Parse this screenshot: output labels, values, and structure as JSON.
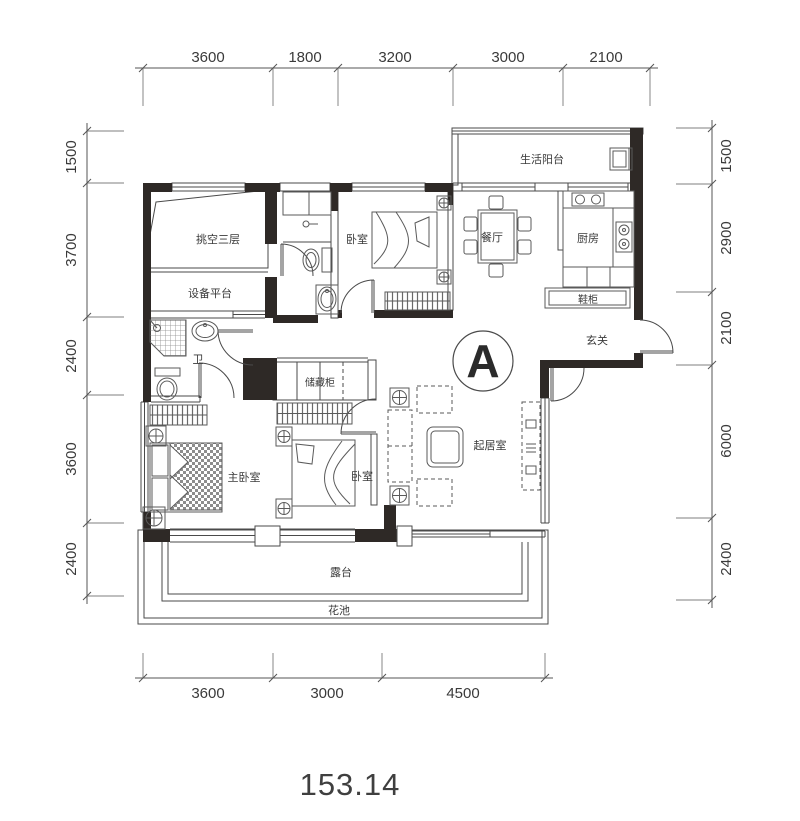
{
  "meta": {
    "area_value": "153.14",
    "block_label": "A"
  },
  "dimensions": {
    "top": [
      "3600",
      "1800",
      "3200",
      "3000",
      "2100"
    ],
    "bottom": [
      "3600",
      "3000",
      "4500"
    ],
    "left": [
      "1500",
      "3700",
      "2400",
      "3600",
      "2400"
    ],
    "right": [
      "1500",
      "2900",
      "2100",
      "6000",
      "2400"
    ]
  },
  "rooms": {
    "living_balcony": "生活阳台",
    "void_3f": "挑空三层",
    "equip_platform": "设备平台",
    "bedroom_top": "卧室",
    "dining": "餐厅",
    "kitchen": "厨房",
    "shoe_cabinet": "鞋柜",
    "entry": "玄关",
    "bath": "卫",
    "storage": "储藏柜",
    "master_bedroom": "主卧室",
    "bedroom_bottom": "卧室",
    "living_room": "起居室",
    "terrace": "露台",
    "flower_bed": "花池"
  },
  "colors": {
    "wall": "#2e2926",
    "line": "#4a4a4a",
    "furniture": "#5a5a5a",
    "text": "#3a3a3a",
    "background": "#ffffff"
  }
}
